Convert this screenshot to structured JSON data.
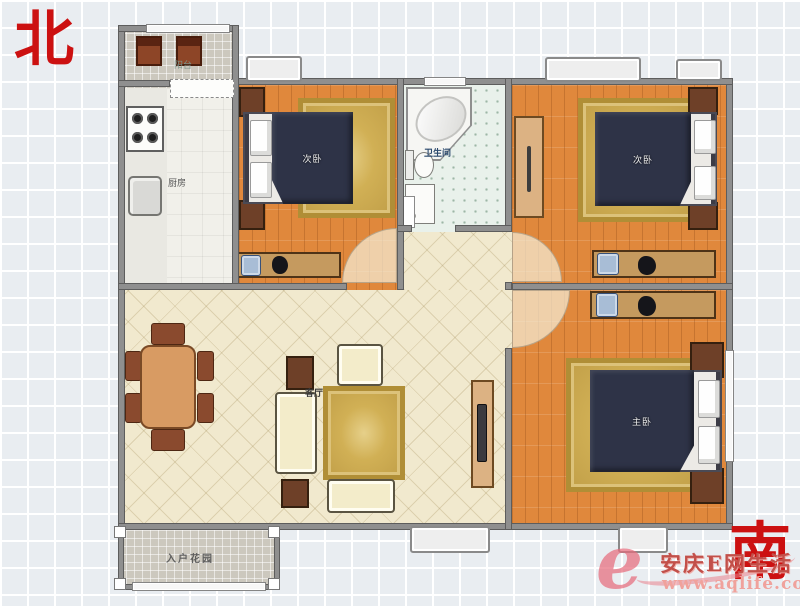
{
  "compass": {
    "north": "北",
    "south": "南"
  },
  "rooms": {
    "balcony": {
      "label": "阳台"
    },
    "kitchen": {
      "label": "厨房"
    },
    "bedroom_north": {
      "label": "次卧"
    },
    "bathroom": {
      "label": "卫生间"
    },
    "bedroom_east": {
      "label": "次卧"
    },
    "master_bedroom": {
      "label": "主卧"
    },
    "living_room": {
      "label": "客厅"
    },
    "entry_garden": {
      "label": "入户花园"
    }
  },
  "watermark": {
    "logo": "e",
    "site_name": "安庆E网生活",
    "url": "www.aqlife.com"
  },
  "colors": {
    "compass_red": "#cc1111",
    "wall_gray": "#8f8f8f",
    "wood_floor_orange": "#e0883c",
    "living_floor_cream": "#f1e9ce",
    "bathroom_floor_mint": "#e9f1eb",
    "tile_gray": "#ccc8be",
    "bed_cover_navy": "#2e3347",
    "rug_gold": "#c9a94e",
    "furniture_brown": "#6e4028",
    "watermark_pink": "#ef9a94"
  }
}
